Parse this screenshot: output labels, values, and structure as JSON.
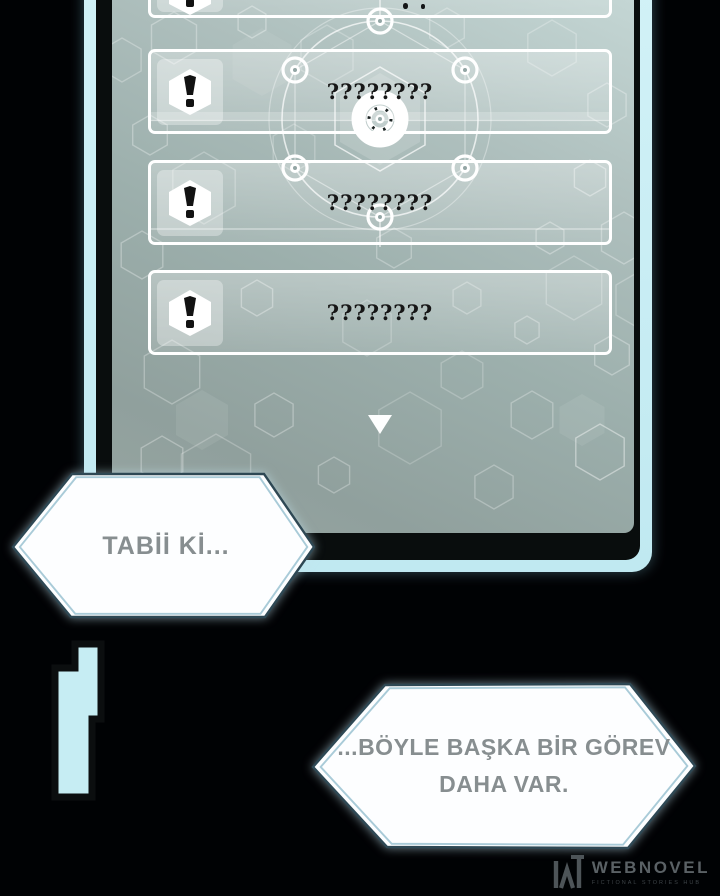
{
  "panel": {
    "rows": [
      {
        "icon": "exclamation-icon",
        "label": "????????"
      },
      {
        "icon": "exclamation-icon",
        "label": "????????"
      },
      {
        "icon": "exclamation-icon",
        "label": "????????"
      }
    ],
    "partial_top_row": {
      "icon": "exclamation-icon"
    },
    "scroll_arrow_icon": "down-triangle-icon",
    "center_decoration_icon": "target-icon"
  },
  "speech_bubbles": [
    {
      "text": "TABİİ Kİ..."
    },
    {
      "lines": [
        "...BÖYLE BAŞKA BİR GÖREV",
        "DAHA VAR."
      ]
    }
  ],
  "footer": {
    "logo_icon": "webnovel-w-icon",
    "brand": "WEBNOVEL",
    "tagline": "FICTIONAL STORIES HUB"
  },
  "colors": {
    "accent_cyan": "#c6edf3",
    "panel_surface": "#a2b4b1",
    "row_border": "#ffffff",
    "ink": "#161616",
    "bubble_border": "#2e4854",
    "bubble_text": "#878e90",
    "brand_text": "#5a6165"
  }
}
